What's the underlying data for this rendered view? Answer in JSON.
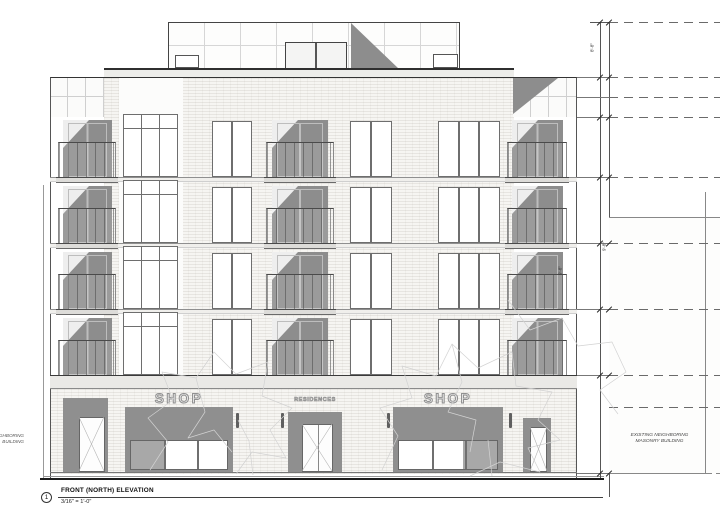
{
  "drawing": {
    "detail_number": "1",
    "title": "FRONT (NORTH) ELEVATION",
    "scale": "3/16\" = 1'-0\"",
    "signs": {
      "shop": "SHOP",
      "entrance": "RESIDENCES"
    },
    "neighbor_right": {
      "line1": "EXISTING NEIGHBORING",
      "line2": "MASONRY BUILDING"
    },
    "neighbor_left": {
      "line1": "EXISTING NEIGHBORING",
      "line2": "BUILDING"
    },
    "dims": [
      "8'-8\"",
      "9'-8\"",
      "9'-8\""
    ],
    "colors": {
      "shadow": "#8d8d8d",
      "frame": "#6e6e6e",
      "ink": "#2f2f2f",
      "brick": "#f6f5f2"
    },
    "elevation": {
      "stories": 5,
      "residential_floors": 4,
      "floor_tops": [
        111,
        177,
        243,
        309
      ],
      "bays": [
        {
          "name": "balcony-left",
          "type": "balcony",
          "x": 63,
          "w": 49,
          "rx": 58,
          "rw": 58
        },
        {
          "name": "feature-window",
          "type": "feature",
          "x": 123,
          "w": 55,
          "panes": 3
        },
        {
          "name": "window-a",
          "type": "window",
          "x": 212,
          "w": 40,
          "panes": 2
        },
        {
          "name": "balcony-center",
          "type": "balcony",
          "x": 272,
          "w": 56,
          "rx": 266,
          "rw": 68
        },
        {
          "name": "window-b",
          "type": "window",
          "x": 350,
          "w": 42,
          "panes": 2
        },
        {
          "name": "window-c",
          "type": "window",
          "x": 438,
          "w": 62,
          "panes": 3
        },
        {
          "name": "balcony-right",
          "type": "balcony",
          "x": 512,
          "w": 51,
          "rx": 507,
          "rw": 60
        }
      ]
    }
  }
}
